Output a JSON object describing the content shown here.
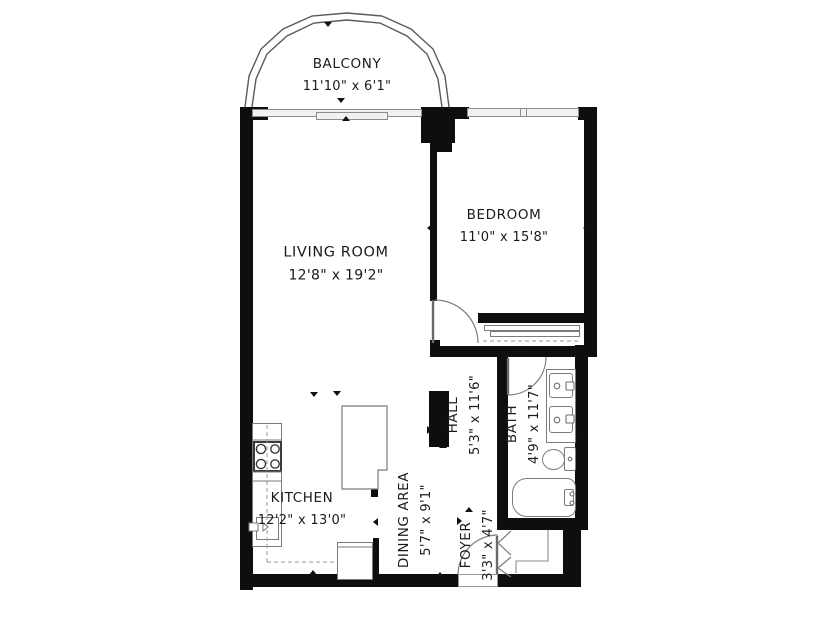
{
  "plan": {
    "rooms": [
      {
        "name": "BALCONY",
        "dims": "11'10\" x 6'1\""
      },
      {
        "name": "LIVING ROOM",
        "dims": "12'8\" x 19'2\""
      },
      {
        "name": "BEDROOM",
        "dims": "11'0\" x 15'8\""
      },
      {
        "name": "HALL",
        "dims": "5'3\" x 11'6\""
      },
      {
        "name": "BATH",
        "dims": "4'9\" x 11'7\""
      },
      {
        "name": "KITCHEN",
        "dims": "12'2\" x 13'0\""
      },
      {
        "name": "DINING AREA",
        "dims": "5'7\" x 9'1\""
      },
      {
        "name": "FOYER",
        "dims": "3'3\" x 4'7\""
      }
    ],
    "colors": {
      "wall": "#0e0e0e",
      "fixture_line": "#7b7b7b",
      "text": "#1b1b1b",
      "background": "#ffffff"
    }
  }
}
